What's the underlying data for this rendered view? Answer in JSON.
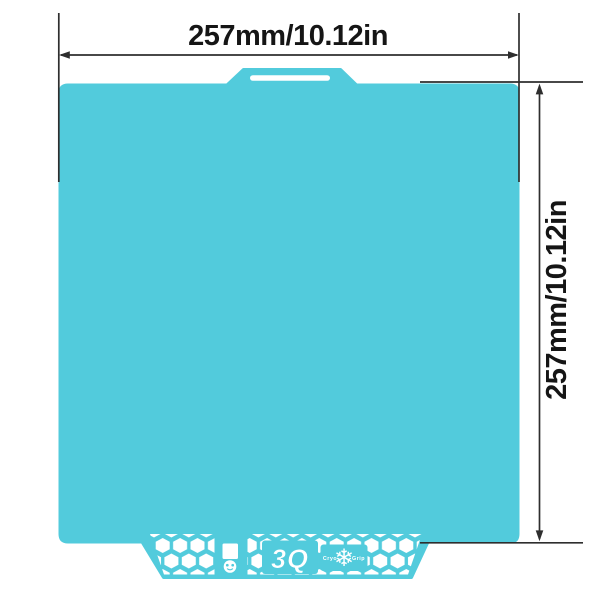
{
  "theme": {
    "teal": "#52CBDC",
    "line": "#2e2e2e",
    "ink": "#151515",
    "cutout": "#ffffff"
  },
  "diagram": {
    "dimensions": {
      "width": {
        "label": "257mm/10.12in"
      },
      "height": {
        "label": "257mm/10.12in"
      }
    },
    "plate": {
      "bottom_tab": {
        "brand_mark": "3Q",
        "grip_brand_left": "Cryo",
        "grip_brand_right": "Grip",
        "snowflake_glyph": "❄"
      }
    }
  }
}
